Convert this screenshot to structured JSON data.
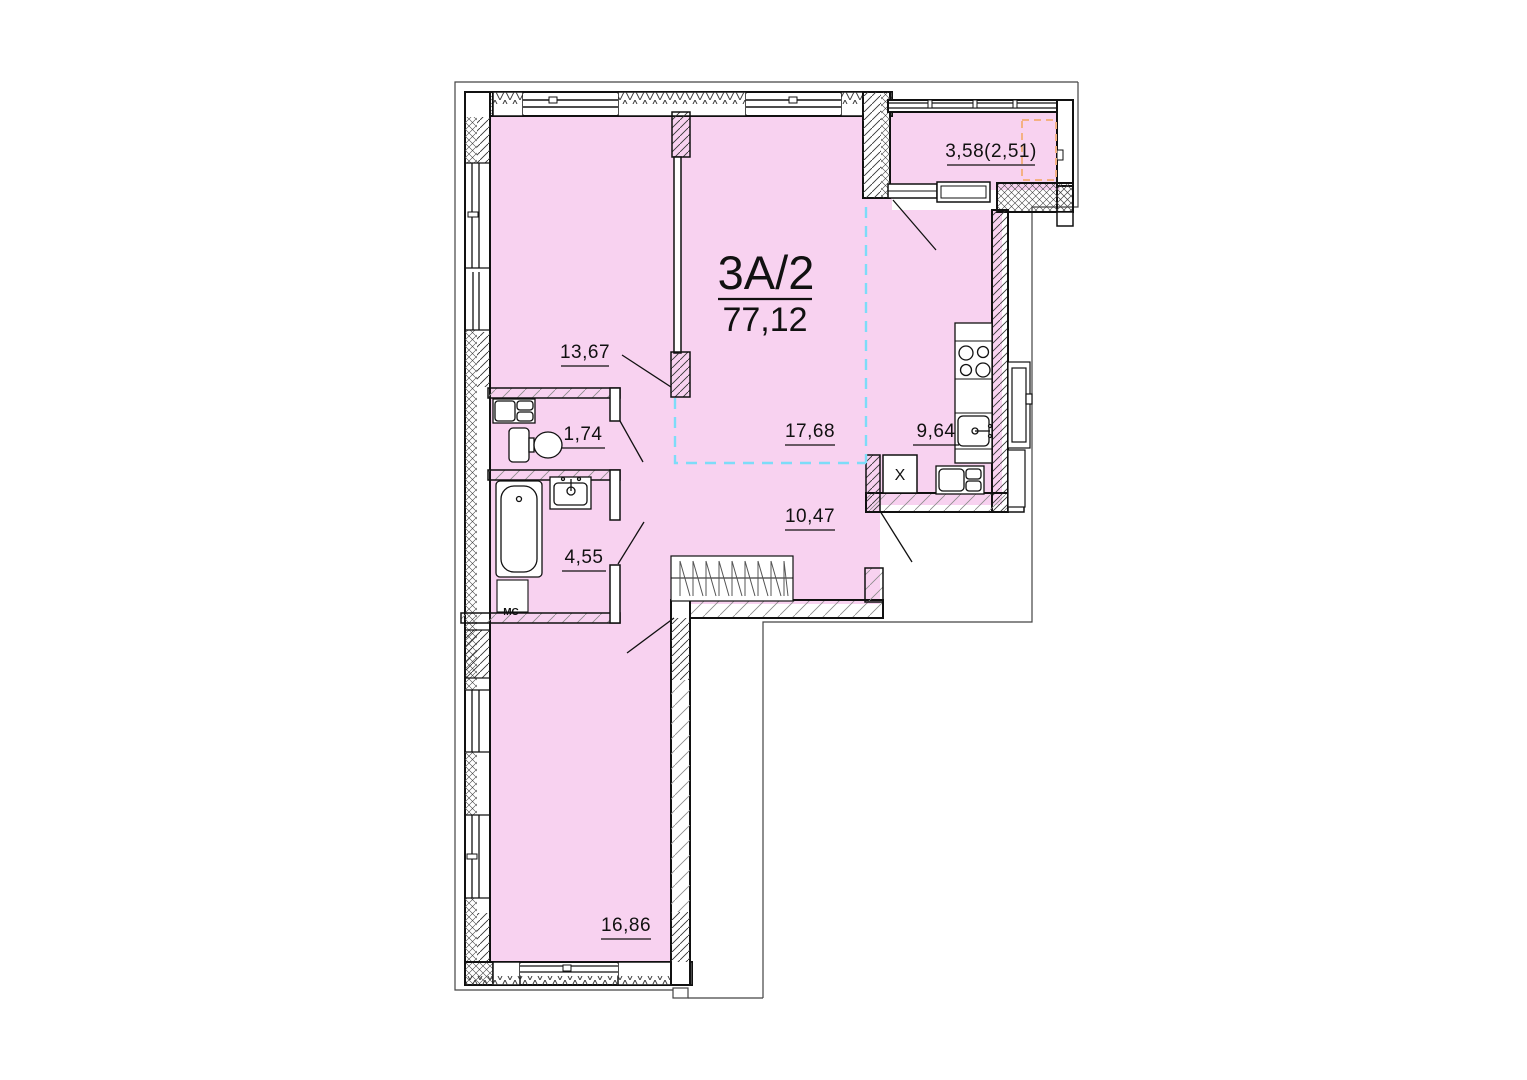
{
  "plan": {
    "unit": {
      "name": "3А/2",
      "total_area": "77,12"
    },
    "rooms": [
      {
        "key": "room-top-left",
        "area": "13,67"
      },
      {
        "key": "wc",
        "area": "1,74"
      },
      {
        "key": "bathroom",
        "area": "4,55"
      },
      {
        "key": "living-zone",
        "area": "17,68"
      },
      {
        "key": "kitchen-zone",
        "area": "9,64"
      },
      {
        "key": "hallway",
        "area": "10,47"
      },
      {
        "key": "bedroom",
        "area": "16,86"
      },
      {
        "key": "balcony",
        "area": "3,58(2,51)"
      }
    ],
    "annotations": {
      "washing_machine": "МС",
      "vent_shaft": "Х"
    },
    "colors": {
      "room_fill": "#f8d2f0",
      "zone_line": "#7ddcf8",
      "balcony_zone_line": "#f4b183"
    }
  }
}
